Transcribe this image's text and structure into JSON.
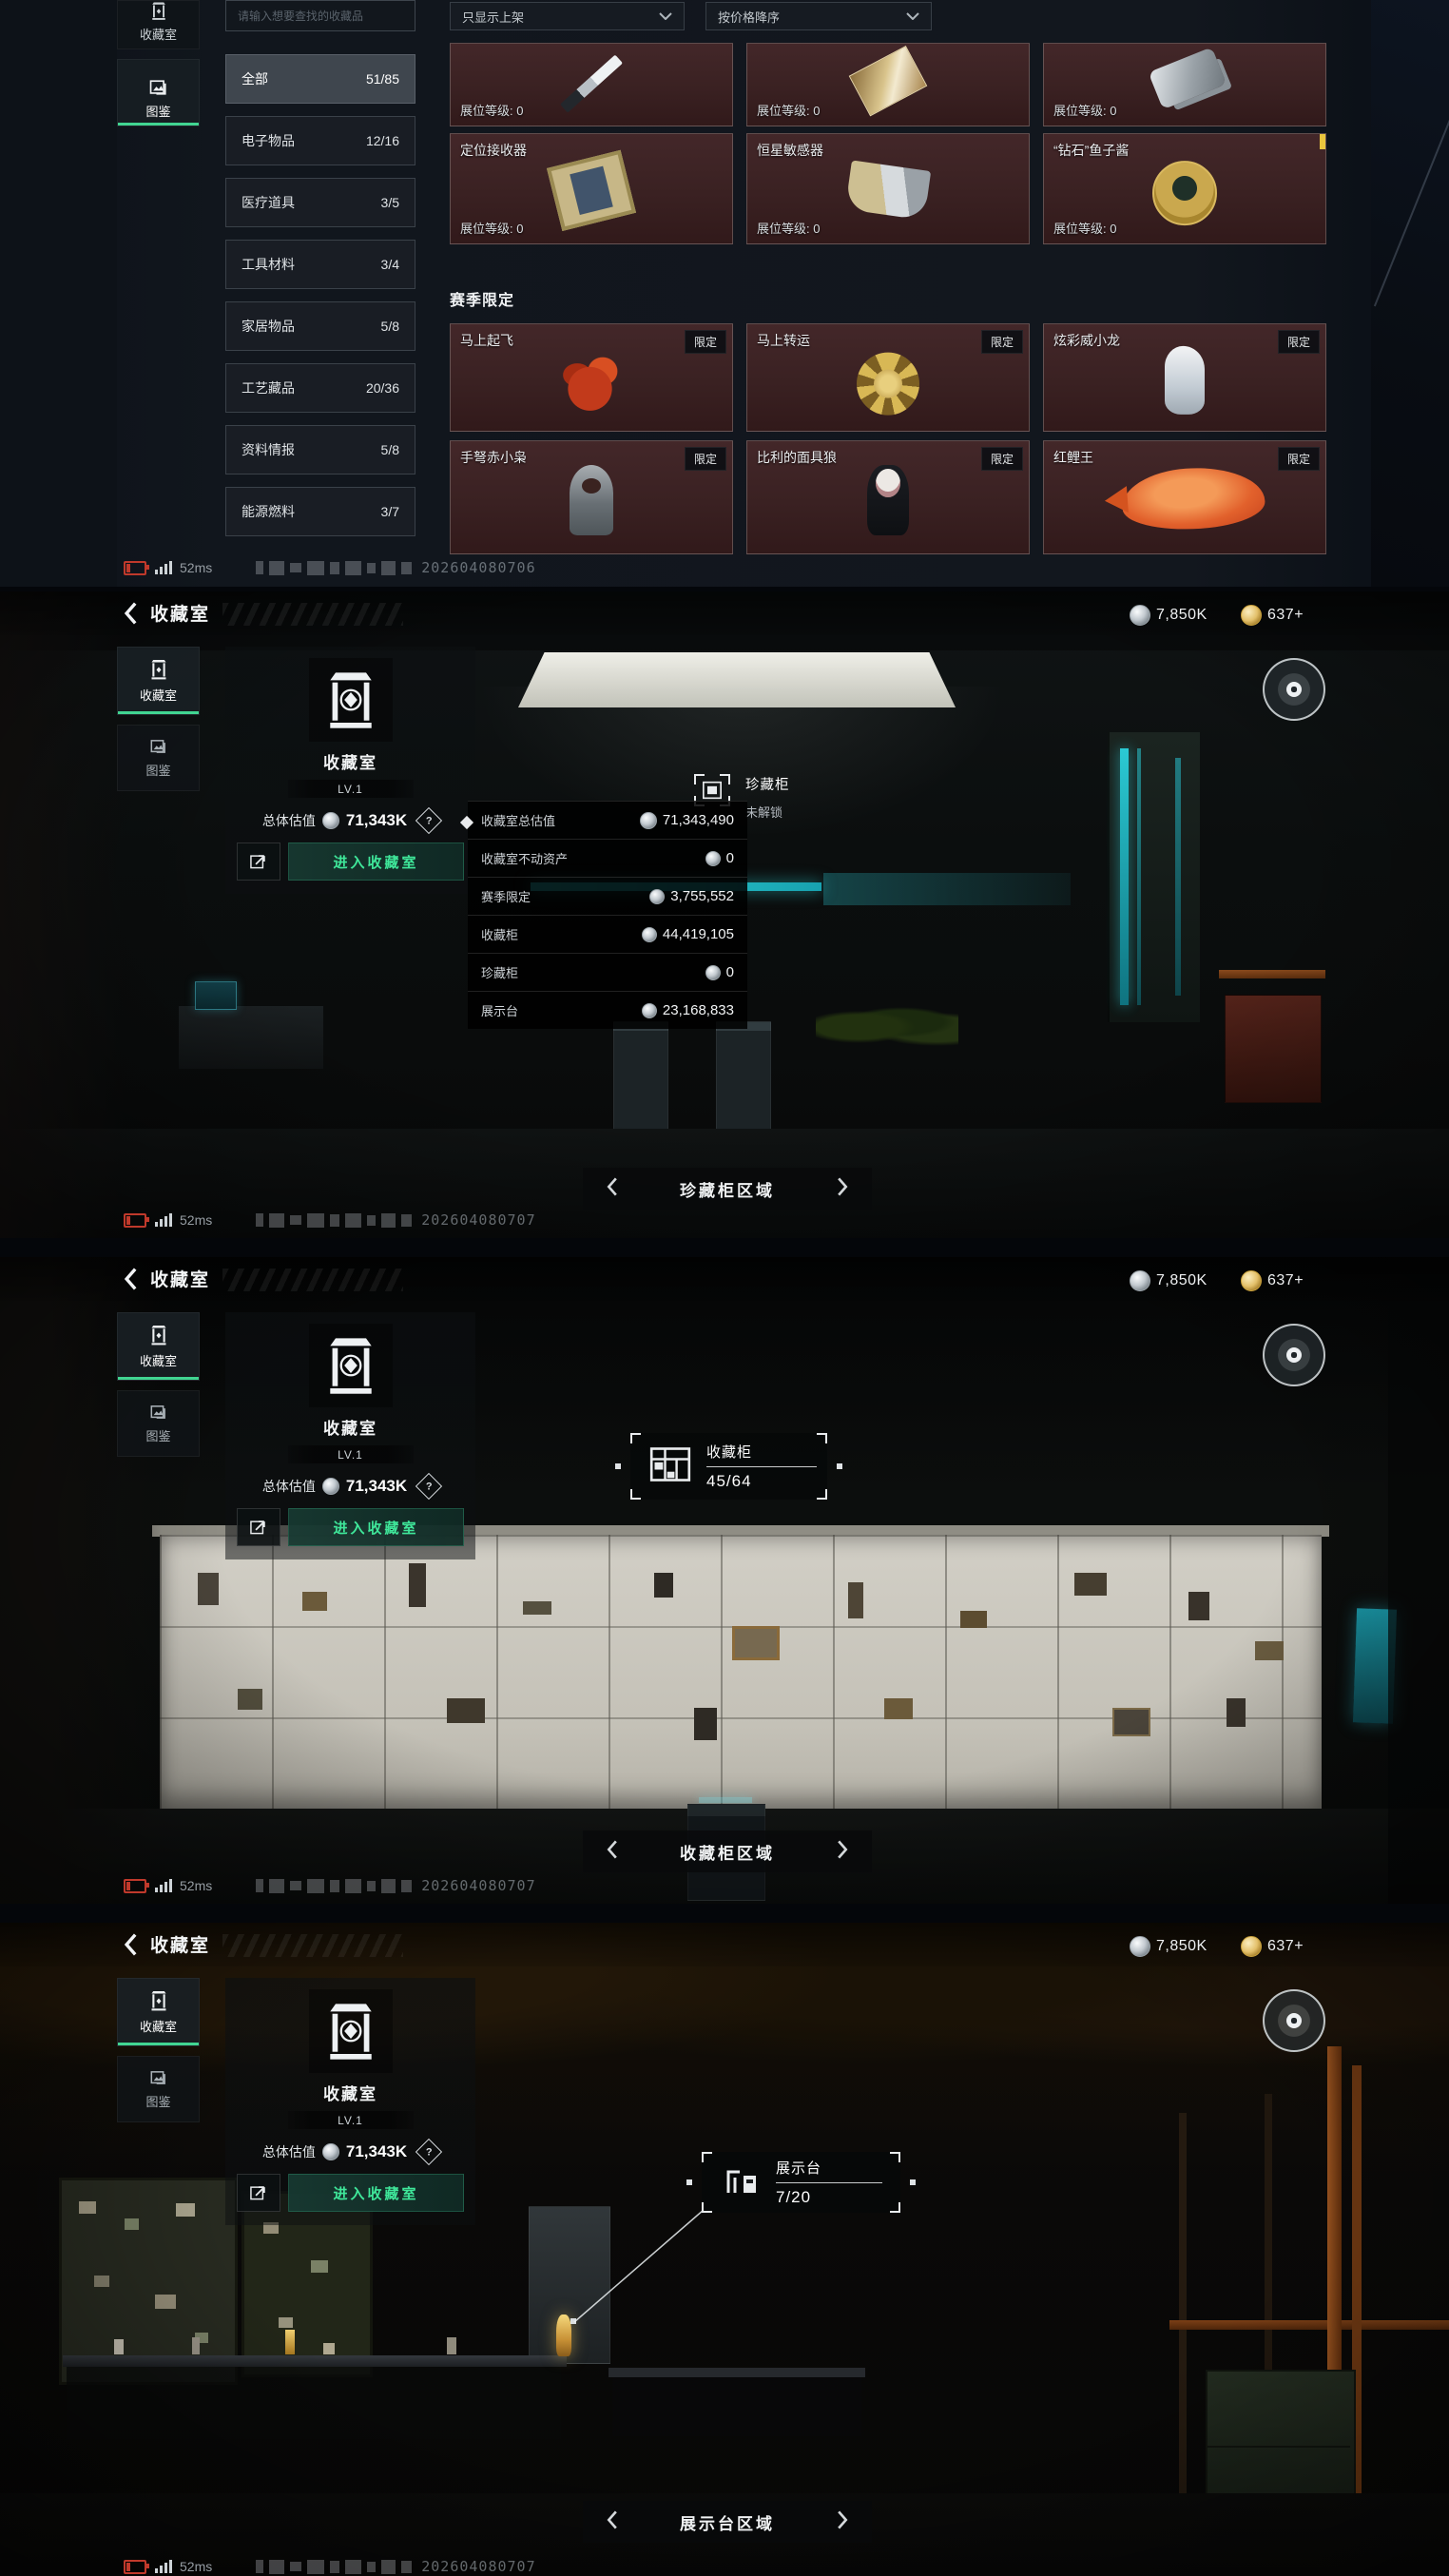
{
  "currency": {
    "silver": "7,850K",
    "gold": "637+"
  },
  "status": {
    "ping": "52ms",
    "wm1": "202604080706",
    "wm2": "202604080707",
    "wm3": "202604080707",
    "wm4": "202604080707"
  },
  "catalog": {
    "tab_room": "收藏室",
    "tab_codex": "图鉴",
    "search_placeholder": "请输入想要查找的收藏品",
    "filter_onsale": "只显示上架",
    "filter_sort": "按价格降序",
    "categories": [
      {
        "label": "全部",
        "count": "51/85"
      },
      {
        "label": "电子物品",
        "count": "12/16"
      },
      {
        "label": "医疗道具",
        "count": "3/5"
      },
      {
        "label": "工具材料",
        "count": "3/4"
      },
      {
        "label": "家居物品",
        "count": "5/8"
      },
      {
        "label": "工艺藏品",
        "count": "20/36"
      },
      {
        "label": "资料情报",
        "count": "5/8"
      },
      {
        "label": "能源燃料",
        "count": "3/7"
      }
    ],
    "booth_label": "展位等级: 0",
    "row1": [
      {
        "name": "定位接收器"
      },
      {
        "name": "恒星敏感器"
      },
      {
        "name": "“钻石”鱼子酱"
      }
    ],
    "season_title": "赛季限定",
    "limited_badge": "限定",
    "season": [
      {
        "name": "马上起飞"
      },
      {
        "name": "马上转运"
      },
      {
        "name": "炫彩威小龙"
      },
      {
        "name": "手弩赤小枭"
      },
      {
        "name": "比利的面具狼"
      },
      {
        "name": "红鲤王"
      }
    ]
  },
  "room": {
    "title": "收藏室",
    "tab_room": "收藏室",
    "tab_codex": "图鉴",
    "level": "LV.1",
    "value_label": "总体估值",
    "value": "71,343K",
    "help_mark": "?",
    "enter_button": "进入收藏室"
  },
  "panel2": {
    "nav": "珍藏柜区域",
    "marker_title": "珍藏柜",
    "marker_sub": "未解锁",
    "tooltip": {
      "rows": [
        {
          "label": "收藏室总估值",
          "value": "71,343,490"
        },
        {
          "label": "收藏室不动资产",
          "value": "0"
        },
        {
          "label": "赛季限定",
          "value": "3,755,552"
        },
        {
          "label": "收藏柜",
          "value": "44,419,105"
        },
        {
          "label": "珍藏柜",
          "value": "0"
        },
        {
          "label": "展示台",
          "value": "23,168,833"
        }
      ]
    }
  },
  "panel3": {
    "nav": "收藏柜区域",
    "marker_title": "收藏柜",
    "marker_count": "45/64"
  },
  "panel4": {
    "nav": "展示台区域",
    "marker_title": "展示台",
    "marker_count": "7/20"
  }
}
